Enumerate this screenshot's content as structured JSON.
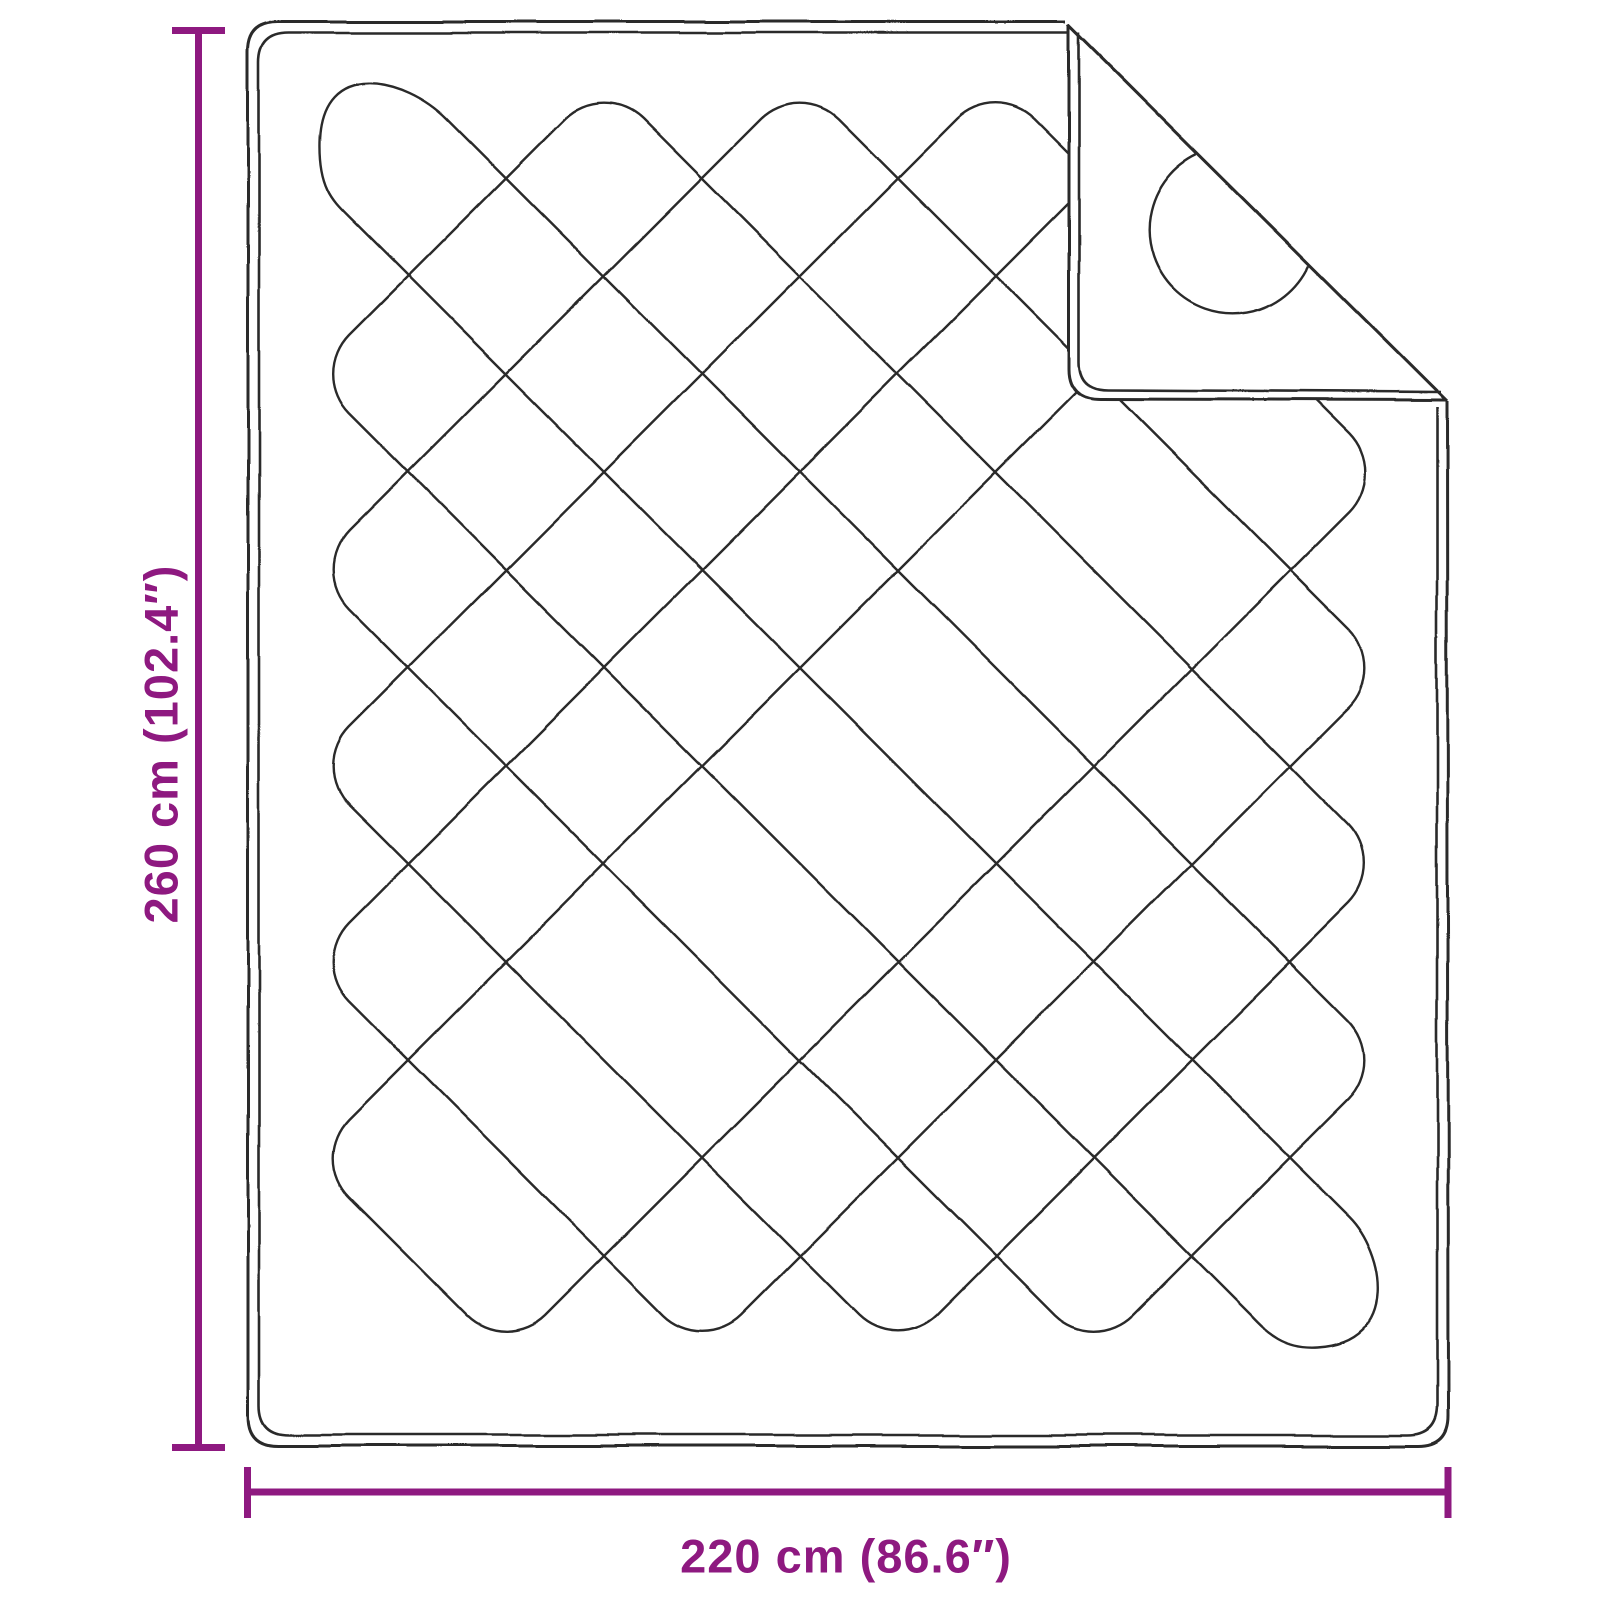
{
  "diagram": {
    "labels": {
      "height": "260 cm (102.4″)",
      "width": "220 cm (86.6″)"
    },
    "colors": {
      "dimension_accent": "#8E1980",
      "outline": "#2B2B2B",
      "background": "#FFFFFF"
    }
  }
}
